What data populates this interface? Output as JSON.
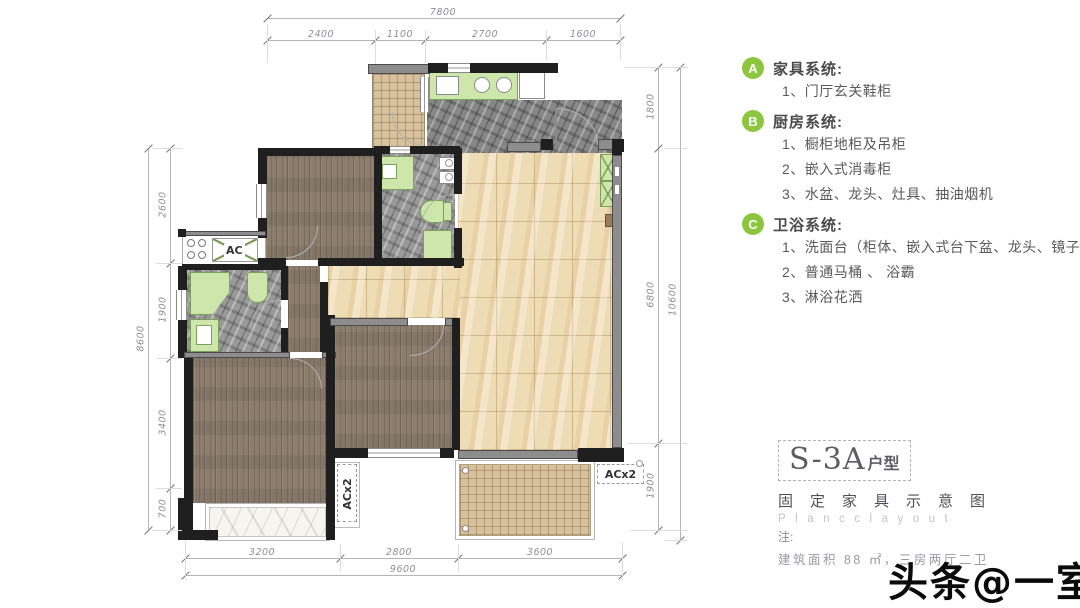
{
  "legend": {
    "badge_color": "#8cc63e",
    "sections": [
      {
        "badge": "A",
        "title": "家具系统:",
        "items": [
          "1、门厅玄关鞋柜"
        ]
      },
      {
        "badge": "B",
        "title": "厨房系统:",
        "items": [
          "1、橱柜地柜及吊柜",
          "2、嵌入式消毒柜",
          "3、水盆、龙头、灶具、抽油烟机"
        ]
      },
      {
        "badge": "C",
        "title": "卫浴系统:",
        "items": [
          "1、洗面台（柜体、嵌入式台下盆、龙头、镜子）",
          "2、普通马桶 、 浴霸",
          "3、淋浴花洒"
        ]
      }
    ]
  },
  "title_block": {
    "unit_name": "S-3A",
    "unit_suffix": "户型",
    "subtitle": "固定家具示意图",
    "subtitle_en": "Plancclayout",
    "note_label": "注:",
    "note_text": "建筑面积 88 ㎡，三房两厅二卫"
  },
  "watermark": "头条@一室",
  "plan": {
    "labels": {
      "ac_platform": "AC",
      "ac_shaft_left": "ACx2",
      "ac_shaft_right": "ACx2"
    },
    "dimensions": {
      "top": {
        "total": "7800",
        "segments": [
          "2400",
          "1100",
          "2700",
          "1600"
        ]
      },
      "left": {
        "total": "8600",
        "segments": [
          "2600",
          "1900",
          "3400",
          "700"
        ]
      },
      "right": {
        "total": "10600",
        "segments": [
          "1800",
          "6800",
          "1900"
        ]
      },
      "bottom": {
        "total": "9600",
        "segments": [
          "3200",
          "2800",
          "3600"
        ]
      }
    }
  }
}
